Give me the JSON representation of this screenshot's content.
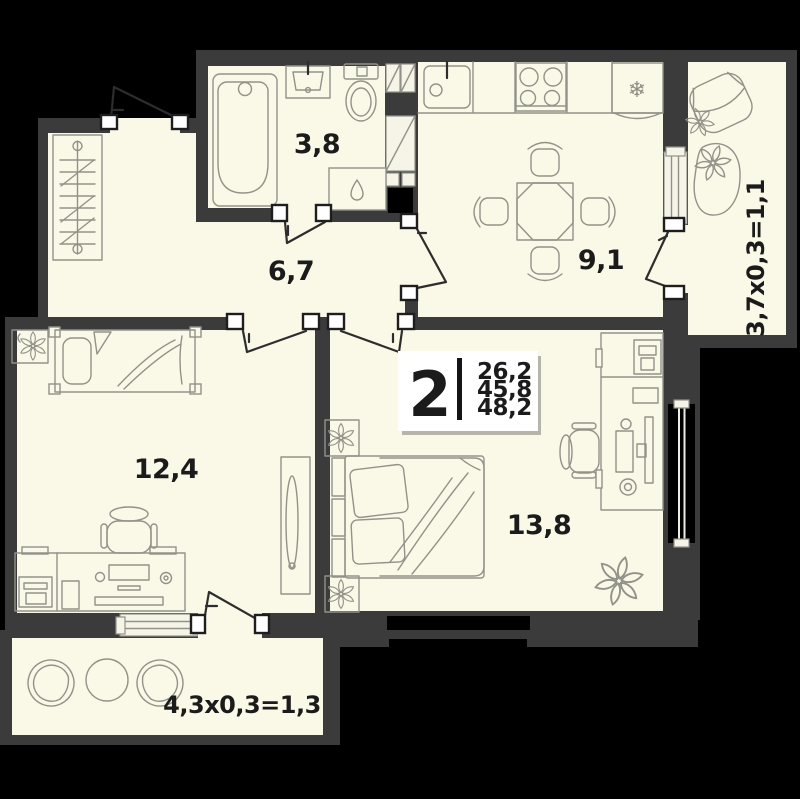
{
  "unit_card": {
    "rooms_count": "2",
    "area_living": "26,2",
    "area_apartment": "45,8",
    "area_total": "48,2"
  },
  "rooms": {
    "bathroom": {
      "area": "3,8"
    },
    "hallway": {
      "area": "6,7"
    },
    "kitchen": {
      "area": "9,1"
    },
    "bedroom_left": {
      "area": "12,4"
    },
    "bedroom_right": {
      "area": "13,8"
    }
  },
  "balconies": {
    "right": {
      "dimensions": "3,7x0,3=1,1"
    },
    "bottom": {
      "dimensions": "4,3x0,3=1,3"
    }
  },
  "icons": {
    "fridge_snowflake": "❄"
  },
  "colors": {
    "background": "#000000",
    "wall": "#3b3b3b",
    "floor": "#faf8e6",
    "furniture_outline": "#92928a",
    "label_text": "#1b1b1b",
    "card_background": "#ffffff"
  }
}
